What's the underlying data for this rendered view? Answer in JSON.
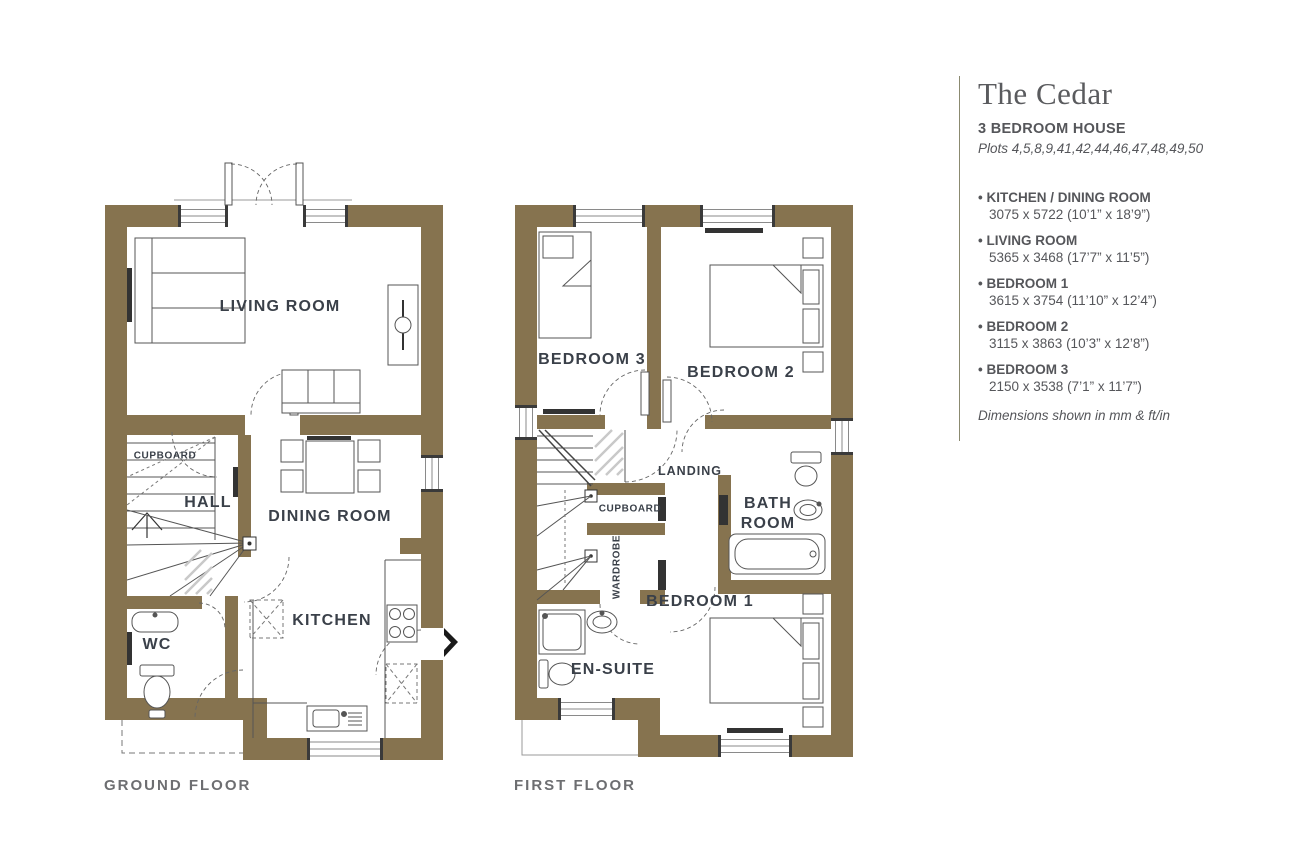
{
  "panel": {
    "title": "The Cedar",
    "subtitle": "3 BEDROOM HOUSE",
    "plots": "Plots 4,5,8,9,41,42,44,46,47,48,49,50",
    "specs": [
      {
        "name": "KITCHEN / DINING ROOM",
        "dims": "3075 x 5722 (10’1” x 18’9”)"
      },
      {
        "name": "LIVING ROOM",
        "dims": "5365 x 3468 (17’7” x 11’5”)"
      },
      {
        "name": "BEDROOM 1",
        "dims": "3615 x 3754 (11’10” x 12’4”)"
      },
      {
        "name": "BEDROOM 2",
        "dims": "3115 x 3863 (10’3” x 12’8”)"
      },
      {
        "name": "BEDROOM 3",
        "dims": "2150 x 3538 (7’1” x 11’7”)"
      }
    ],
    "footnote": "Dimensions shown in mm & ft/in"
  },
  "ground_floor": {
    "caption": "GROUND FLOOR",
    "rooms": {
      "living": "LIVING ROOM",
      "cupboard": "CUPBOARD",
      "hall": "HALL",
      "dining": "DINING ROOM",
      "wc": "WC",
      "kitchen": "KITCHEN"
    }
  },
  "first_floor": {
    "caption": "FIRST FLOOR",
    "rooms": {
      "bedroom3": "BEDROOM 3",
      "bedroom2": "BEDROOM 2",
      "landing": "LANDING",
      "cupboard": "CUPBOARD",
      "wardrobe": "WARDROBE",
      "bathroom": "BATH ROOM",
      "bedroom1": "BEDROOM 1",
      "ensuite": "EN-SUITE"
    }
  },
  "colors": {
    "wall": "#86734F",
    "room_label": "#3A4049",
    "muted_label": "#6D6E71",
    "panel_text": "#55565A",
    "divider": "#8B8A70"
  }
}
